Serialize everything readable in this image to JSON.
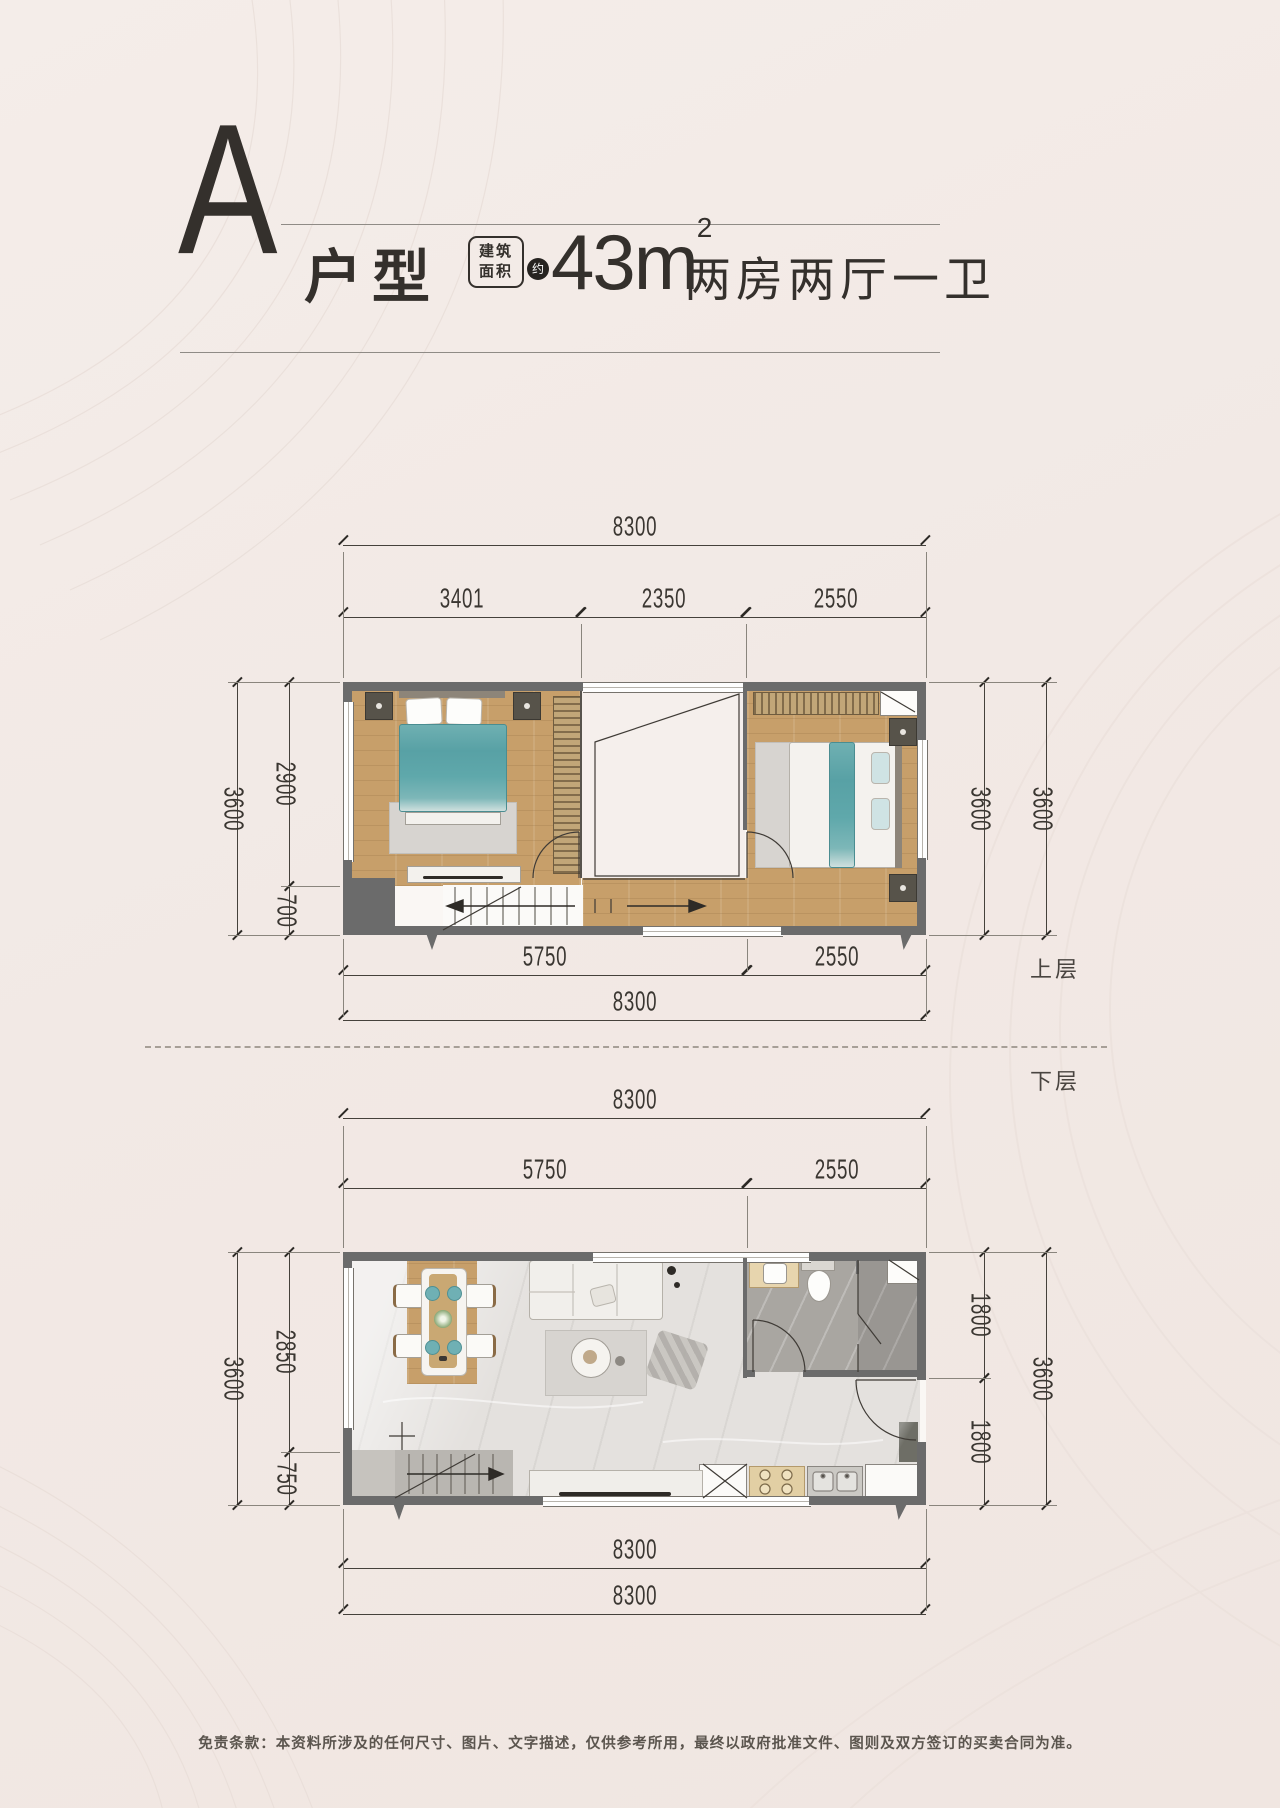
{
  "title": {
    "letter": "A",
    "type_label": "户型",
    "area_badge_line1": "建筑",
    "area_badge_line2": "面积",
    "approx": "约",
    "area_number": "43",
    "area_unit": "m",
    "area_power": "2",
    "layout_label": "两房两厅一卫"
  },
  "floor_labels": {
    "upper": "上层",
    "lower": "下层"
  },
  "upper_dims": {
    "top_total": "8300",
    "top_segments": [
      "3401",
      "2350",
      "2550"
    ],
    "left_outer": "3600",
    "left_segments": [
      "2900",
      "700"
    ],
    "right_inner": "3600",
    "right_outer": "3600",
    "bottom_segments": [
      "5750",
      "2550"
    ],
    "bottom_total": "8300"
  },
  "lower_dims": {
    "top_total": "8300",
    "top_segments": [
      "5750",
      "2550"
    ],
    "left_outer": "3600",
    "left_segments": [
      "2850",
      "750"
    ],
    "right_segments": [
      "1800",
      "1800"
    ],
    "right_outer": "3600",
    "bottom_total_inner": "8300",
    "bottom_total_outer": "8300"
  },
  "footer": {
    "disclaimer": "免责条款：本资料所涉及的任何尺寸、图片、文字描述，仅供参考所用，最终以政府批准文件、图则及双方签订的买卖合同为准。"
  },
  "colors": {
    "background": "#f3ebe7",
    "ink": "#34302c",
    "wall_gray": "#6b6b6b",
    "wood": "#c79f6a",
    "marble": "#e4e1de",
    "bath_tile": "#a9a6a1",
    "accent_teal": "#5fa8ab"
  }
}
